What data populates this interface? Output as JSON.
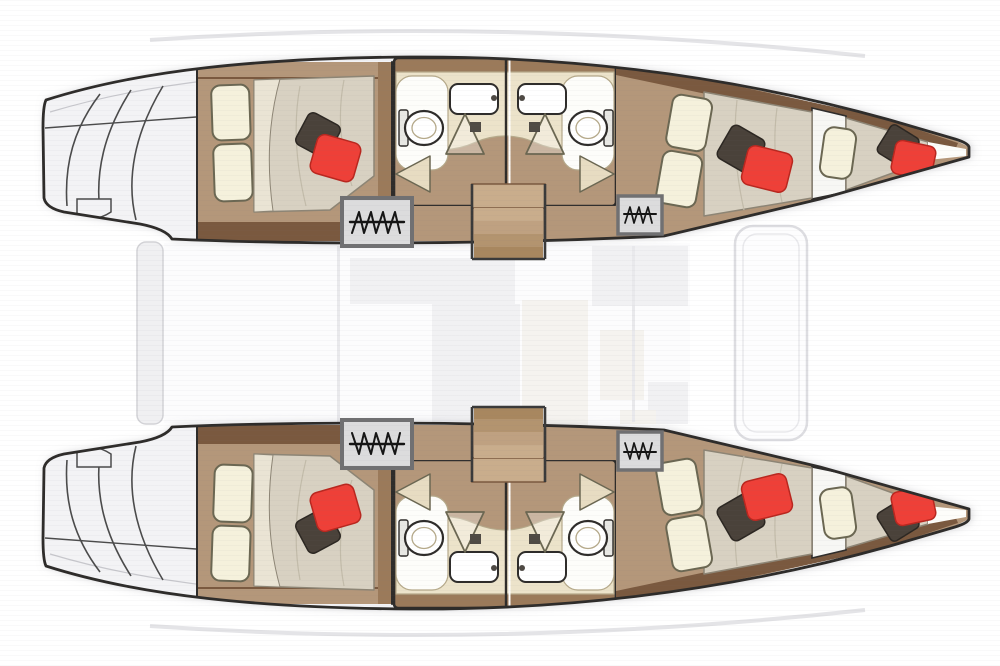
{
  "meta": {
    "title": "Catamaran yacht interior floor plan, top view with bows pointing right: 4 double cabins, 4 bathrooms, 2 forepeak berths, faded central salon",
    "image_type": "boat layout diagram",
    "orientation": "bows to the right, sterns with transom steps to the left"
  },
  "colors": {
    "outline": "#2e2c2a",
    "hull_fill": "#f3f3f5",
    "deck_line": "#c7c7cc",
    "line_soft": "#4b4b4b",
    "wood": "#b4977a",
    "wood_mid": "#9b7a5a",
    "wood_dark": "#7a593f",
    "counter": "#ece3ca",
    "counter_line": "#b5a98a",
    "fixture": "#fdfdfa",
    "divider_white": "#ffffff",
    "tank": "#e8e8e4",
    "drain": "#4f4a44",
    "door": "#e7dcc2",
    "mattress": "#d8d1c2",
    "mattress_light": "#eae4d4",
    "mattress_line": "#8d8575",
    "crease": "#c2bba9",
    "pillow": "#f5f1dc",
    "pillow_line": "#6b6752",
    "dark_pillow": "#4a423a",
    "dark_pillow_line": "#2c2722",
    "red": "#ee4038",
    "red_line": "#b9271f",
    "box_fill": "#dcdcdd",
    "box_border": "#707072",
    "icon_black": "#151515",
    "step_a": "#c9ad8c",
    "step_b": "#bfa181",
    "step_c": "#b3946f",
    "step_d": "#a8875f",
    "stair_rail": "#3a3a3a",
    "partition": "#f7f7f4",
    "salon_bg": "#fcfcfd",
    "ghost1": "#f1f1f3",
    "ghost2": "#f5f3ef",
    "ghost3": "#e9e9ec",
    "ghost_line": "#dddde1",
    "platform_fill": "#f0f0f2",
    "platform_line": "#d2d2d6",
    "arc": "#e4e4e7",
    "fwd_fill": "#fdfdfe"
  },
  "counts": {
    "double_cabins": 4,
    "forepeak_berths": 2,
    "bathrooms": 4,
    "toilets": 4,
    "sinks": 4,
    "showers": 4,
    "companionway_stairs": 2,
    "step_hatches": 4,
    "red_pillows": 6,
    "dark_pillows": 6
  },
  "spaces": [
    {
      "id": "hull-port",
      "label": "Port hull (top)"
    },
    {
      "id": "hull-starboard",
      "label": "Starboard hull (bottom)"
    },
    {
      "id": "aft-cabin",
      "label": "Aft double cabin with island bed"
    },
    {
      "id": "forward-cabin",
      "label": "Forward double cabin"
    },
    {
      "id": "bow-berth",
      "label": "Forepeak berth at the bow tip"
    },
    {
      "id": "bathroom",
      "label": "Bathroom with sink, toilet and shower"
    },
    {
      "id": "companionway-stairs",
      "label": "Companionway stairs down into hull"
    },
    {
      "id": "step-hatch",
      "label": "Step hatch with ladder marks"
    },
    {
      "id": "salon",
      "label": "Central salon and galley (shown faded)"
    },
    {
      "id": "forward-cockpit",
      "label": "Forward cockpit between bows"
    },
    {
      "id": "aft-platform",
      "label": "Aft crossbeam platform between sterns"
    },
    {
      "id": "transom-steps",
      "label": "Curved transom swim steps"
    }
  ],
  "icons": {
    "toilet-icon": "oval bowl with tank",
    "sink-icon": "rounded basin with faucet dot",
    "shower-icon": "triangular shower mat",
    "door-swing-icon": "triangular door leaf",
    "stairs-icon": "wooden treads with side rails",
    "step-hatch-icon": "zigzag ladder marks over a bar"
  }
}
